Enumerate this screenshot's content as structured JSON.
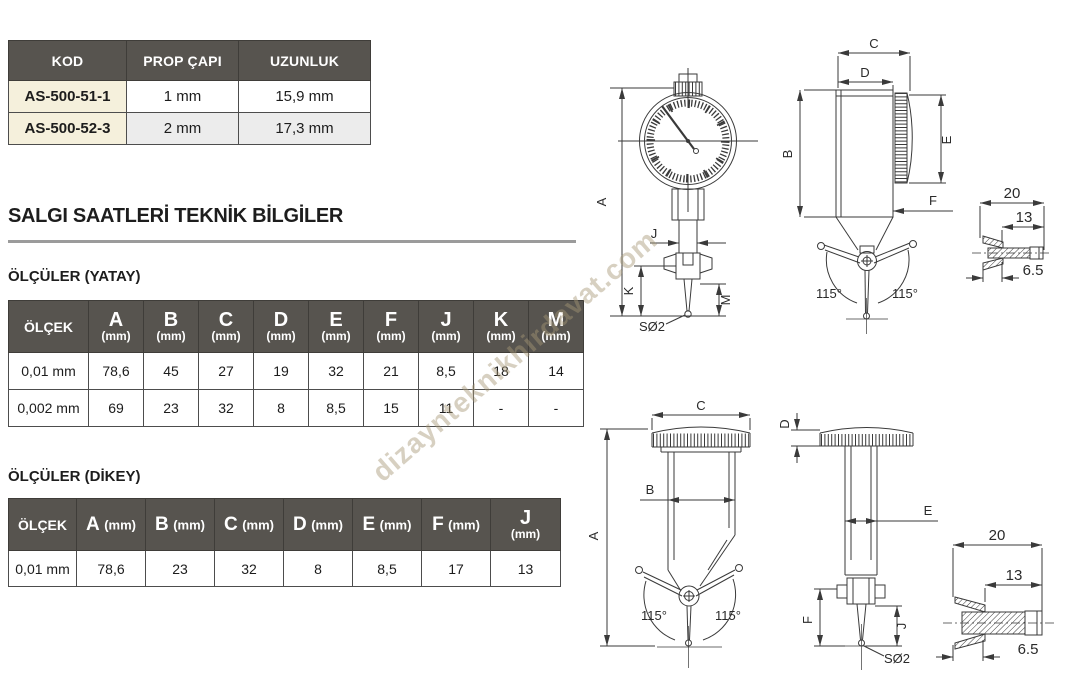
{
  "top_table": {
    "headers": [
      "KOD",
      "PROP ÇAPI",
      "UZUNLUK"
    ],
    "rows": [
      {
        "kod": "AS-500-51-1",
        "prop_capi": "1 mm",
        "uzunluk": "15,9 mm"
      },
      {
        "kod": "AS-500-52-3",
        "prop_capi": "2 mm",
        "uzunluk": "17,3 mm"
      }
    ]
  },
  "section": {
    "title": "SALGI SAATLERİ TEKNİK BİLGİLER",
    "yatay_label": "ÖLÇÜLER (YATAY)",
    "dikey_label": "ÖLÇÜLER (DİKEY)"
  },
  "yatay_table": {
    "scale_header": "ÖLÇEK",
    "unit": "(mm)",
    "dims": [
      "A",
      "B",
      "C",
      "D",
      "E",
      "F",
      "J",
      "K",
      "M"
    ],
    "rows": [
      {
        "scale": "0,01 mm",
        "values": [
          "78,6",
          "45",
          "27",
          "19",
          "32",
          "21",
          "8,5",
          "18",
          "14"
        ]
      },
      {
        "scale": "0,002 mm",
        "values": [
          "69",
          "23",
          "32",
          "8",
          "8,5",
          "15",
          "11",
          "-",
          "-"
        ]
      }
    ]
  },
  "dikey_table": {
    "scale_header": "ÖLÇEK",
    "unit": "(mm)",
    "dims": [
      "A",
      "B",
      "C",
      "D",
      "E",
      "F",
      "J"
    ],
    "rows": [
      {
        "scale": "0,01 mm",
        "values": [
          "78,6",
          "23",
          "32",
          "8",
          "8,5",
          "17",
          "13"
        ]
      }
    ]
  },
  "drawings": {
    "labels": {
      "a": "A",
      "b": "B",
      "c": "C",
      "d": "D",
      "e": "E",
      "f": "F",
      "j": "J",
      "k": "K",
      "m": "M",
      "angle": "115°",
      "tip": "SØ2",
      "w20": "20",
      "w13": "13",
      "w65": "6.5"
    }
  },
  "watermark": {
    "text": "dizaynteknikhirdavat.com"
  },
  "colors": {
    "header_bg": "#57544f",
    "kod_bg": "#f5f0dc",
    "row_alt_bg": "#ececec",
    "border": "#4d4d4d",
    "rule": "#9b9b9b",
    "stroke": "#3a3a3a",
    "watermark": "#a69676"
  }
}
